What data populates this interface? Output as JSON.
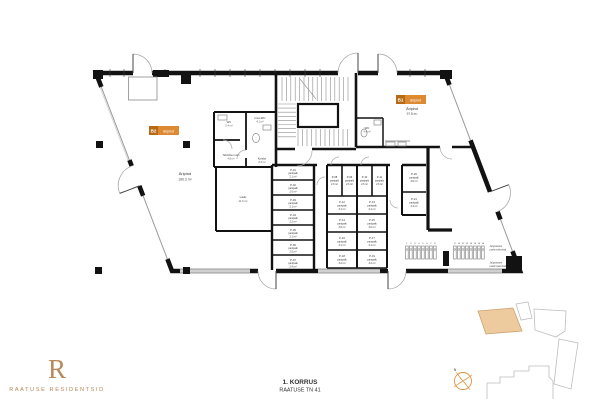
{
  "branding": {
    "monogram": "R",
    "name": "RAATUSE RESIDENTSID"
  },
  "title_block": {
    "floor_label": "1. KORRUS",
    "address": "RAATUSE TN 41"
  },
  "colors": {
    "accent_orange": "#de8a33",
    "accent_orange_dark": "#b66a16",
    "brand_bronze": "#b9895a",
    "site_highlight_fill": "#eeca9f",
    "wall_black": "#121212"
  },
  "commercial_units": [
    {
      "tag": "B2",
      "tag_label": "äripind",
      "room_name": "Äripind",
      "area": "186.3 m²"
    },
    {
      "tag": "B1",
      "tag_label": "äripind",
      "room_name": "Äripind",
      "area": "97.8 m²"
    }
  ],
  "rooms": {
    "wc1": {
      "name": "WC",
      "area": "2.4 m²"
    },
    "wc2": {
      "name": "Inva-WC",
      "area": "4.1 m²"
    },
    "tech": {
      "name": "Tehniline ruum",
      "area": "4.8 m²"
    },
    "corridor": {
      "name": "Koridor",
      "area": "8.3 m²"
    },
    "ladu": {
      "name": "Ladu",
      "area": "11.6 m²"
    },
    "b1wc": {
      "name": "WC",
      "area": "4.4 m²"
    }
  },
  "storage": {
    "column_a": [
      {
        "id": "P-01",
        "name": "panipaik",
        "area": "2.1 m²"
      },
      {
        "id": "P-02",
        "name": "panipaik",
        "area": "2.0 m²"
      },
      {
        "id": "P-03",
        "name": "panipaik",
        "area": "2.1 m²"
      },
      {
        "id": "P-04",
        "name": "panipaik",
        "area": "2.2 m²"
      },
      {
        "id": "P-05",
        "name": "panipaik",
        "area": "2.1 m²"
      },
      {
        "id": "P-06",
        "name": "panipaik",
        "area": "2.0 m²"
      },
      {
        "id": "P-07",
        "name": "panipaik",
        "area": "2.4 m²"
      }
    ],
    "grid_row1": [
      {
        "id": "P-08",
        "name": "panipaik",
        "area": "2.6 m²"
      },
      {
        "id": "P-09",
        "name": "panipaik",
        "area": "2.6 m²"
      },
      {
        "id": "P-10",
        "name": "panipaik",
        "area": "2.6 m²"
      },
      {
        "id": "P-11",
        "name": "panipaik",
        "area": "2.6 m²"
      }
    ],
    "grid_rows": [
      {
        "id": "P-12",
        "name": "panipaik",
        "area": "3.1 m²"
      },
      {
        "id": "P-13",
        "name": "panipaik",
        "area": "3.1 m²"
      },
      {
        "id": "P-14",
        "name": "panipaik",
        "area": "3.0 m²"
      },
      {
        "id": "P-15",
        "name": "panipaik",
        "area": "3.0 m²"
      },
      {
        "id": "P-16",
        "name": "panipaik",
        "area": "3.1 m²"
      },
      {
        "id": "P-17",
        "name": "panipaik",
        "area": "3.1 m²"
      },
      {
        "id": "P-18",
        "name": "panipaik",
        "area": "3.2 m²"
      },
      {
        "id": "P-19",
        "name": "panipaik",
        "area": "3.2 m²"
      }
    ],
    "column_b": [
      {
        "id": "P-20",
        "name": "panipaik",
        "area": "3.6 m²"
      },
      {
        "id": "P-21",
        "name": "panipaik",
        "area": "3.4 m²"
      }
    ]
  },
  "bikes": {
    "group1_numbers": [
      "1",
      "2",
      "3",
      "4",
      "5",
      "6",
      "7",
      "8"
    ],
    "group2_numbers": [
      "9",
      "10",
      "11",
      "12",
      "13",
      "14",
      "15",
      "16"
    ],
    "label_top_1": "Jalgrataste",
    "label_top_2": "parkimiskohad",
    "label_bottom_1": "Jalgrataste",
    "label_bottom_2": "parkimiskohad"
  },
  "compass": {
    "north": "N"
  }
}
